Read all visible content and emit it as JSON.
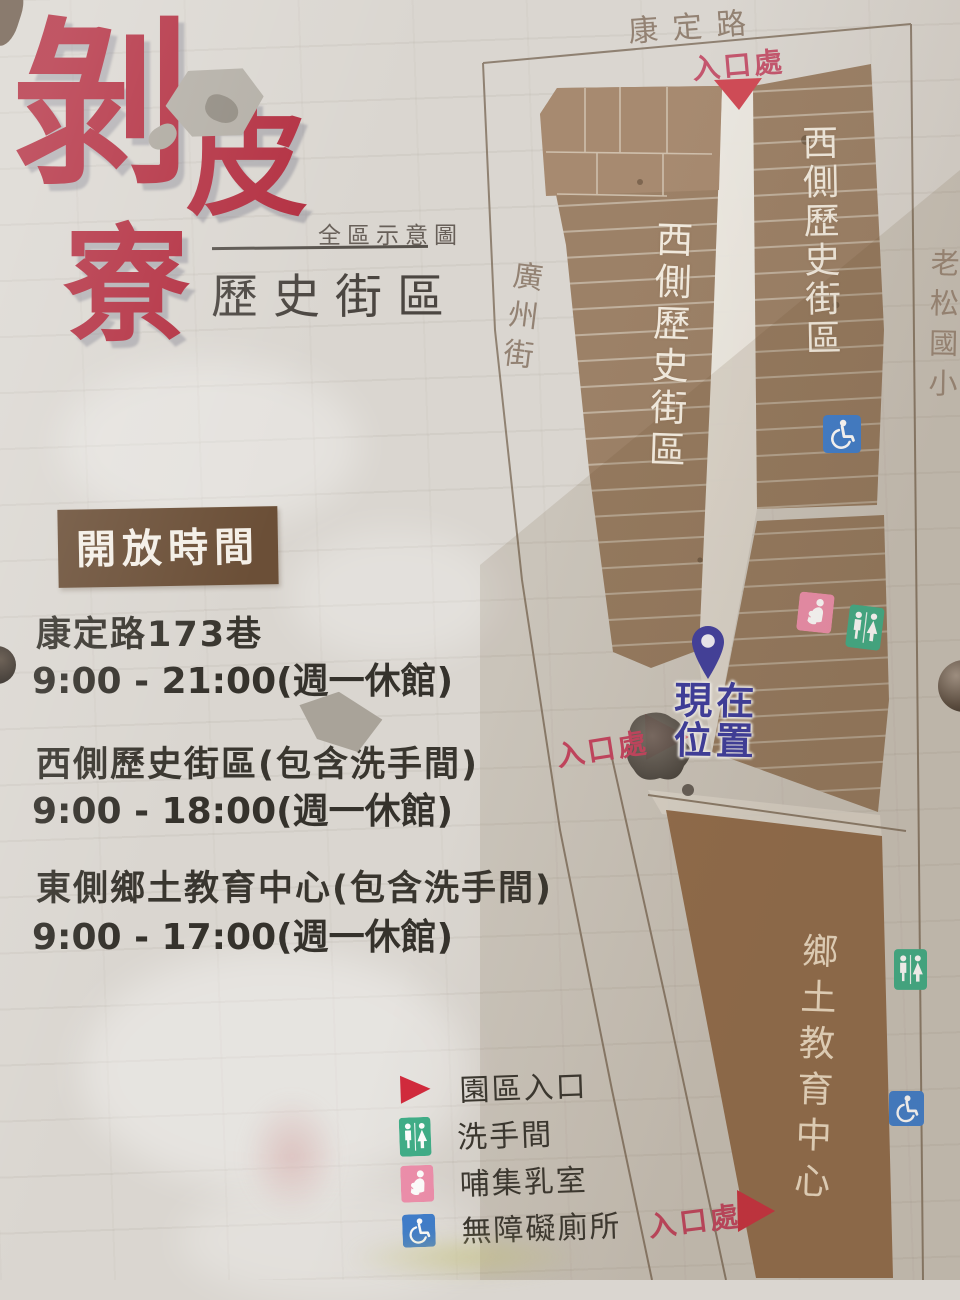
{
  "sign": {
    "logo": {
      "char1": "剝",
      "char2": "皮",
      "char3": "寮",
      "subtitle_small": "全區示意圖",
      "subtitle_large": "歷史街區",
      "accent_color": "#b22c3e"
    },
    "hours": {
      "header": "開放時間",
      "header_bg_color": "#6b4f37",
      "entries": [
        {
          "name": "康定路173巷",
          "time": "9:00 - 21:00(週一休館)"
        },
        {
          "name": "西側歷史街區(包含洗手間)",
          "time": "9:00 - 18:00(週一休館)"
        },
        {
          "name": "東側鄉土教育中心(包含洗手間)",
          "time": "9:00 - 17:00(週一休館)"
        }
      ]
    },
    "legend": {
      "items": [
        {
          "icon": "entrance-triangle-icon",
          "label": "園區入口",
          "color": "#d2293c"
        },
        {
          "icon": "restroom-icon",
          "label": "洗手間",
          "color": "#3fae88"
        },
        {
          "icon": "nursing-room-icon",
          "label": "哺集乳室",
          "color": "#ee8fac"
        },
        {
          "icon": "accessible-toilet-icon",
          "label": "無障礙廁所",
          "color": "#3f7ecd"
        }
      ]
    },
    "map": {
      "street_top": "康定路",
      "street_left": "廣州街",
      "landmark_right": "老松國小",
      "west_block_left": "西側歷史街區",
      "west_block_right": "西側歷史街區",
      "east_block": "鄉土教育中心",
      "entrance_label": "入口處",
      "current_location_line1": "現在",
      "current_location_line2": "位置",
      "pin_color": "#413f9e",
      "block_color": "#9c8167",
      "east_block_color": "#997251"
    }
  }
}
